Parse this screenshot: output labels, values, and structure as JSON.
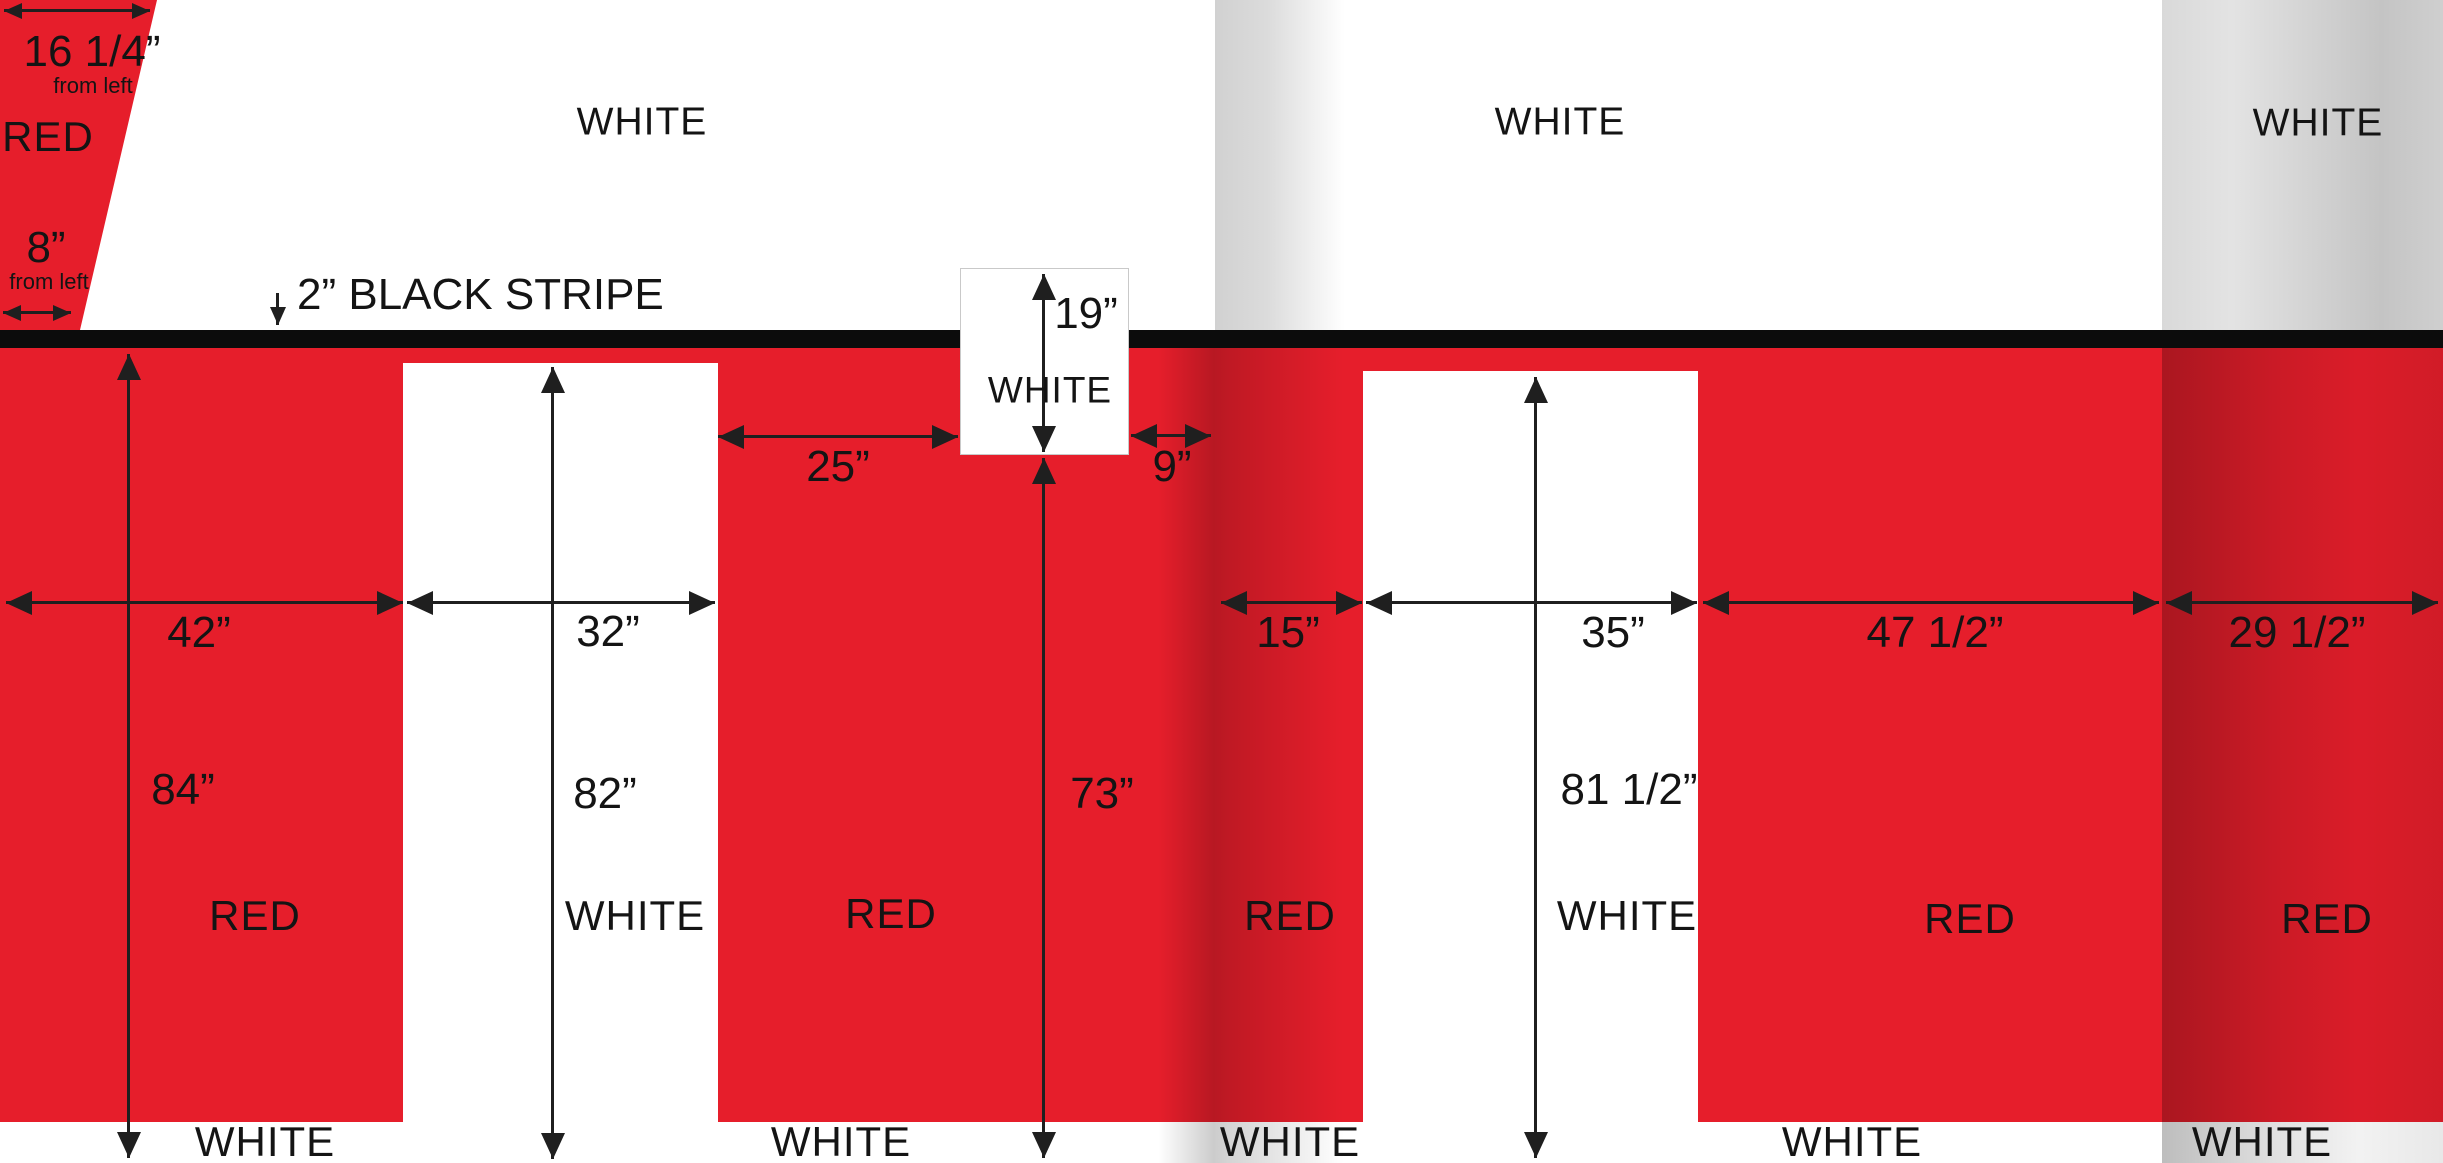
{
  "colors": {
    "red": "#e61e2b",
    "stripe_black": "#0c0c0c",
    "ink": "#1f1f1f",
    "fold_gray": "#c9c9c9",
    "white": "#ffffff"
  },
  "top_whites": [
    "WHITE",
    "WHITE",
    "WHITE"
  ],
  "stripe": {
    "label": "2” BLACK STRIPE"
  },
  "corner": {
    "width_top": "16 1/4”",
    "from_left_top": "from left",
    "zone": "RED",
    "width_bottom": "8”",
    "from_left_bottom": "from left"
  },
  "dims": {
    "w42": "42”",
    "w32": "32”",
    "w25": "25”",
    "w9": "9”",
    "w15": "15”",
    "w35": "35”",
    "w47": "47 1/2”",
    "w29": "29 1/2”",
    "h84": "84”",
    "h82": "82”",
    "h19": "19”",
    "h73": "73”",
    "h81": "81 1/2”"
  },
  "zones": {
    "red_left": "RED",
    "white_panel1": "WHITE",
    "red_mid": "RED",
    "red_15": "RED",
    "white_panel2": "WHITE",
    "red_47": "RED",
    "red_right": "RED",
    "box_white": "WHITE"
  },
  "bottom_whites": [
    "WHITE",
    "WHITE",
    "WHITE",
    "WHITE",
    "WHITE"
  ]
}
